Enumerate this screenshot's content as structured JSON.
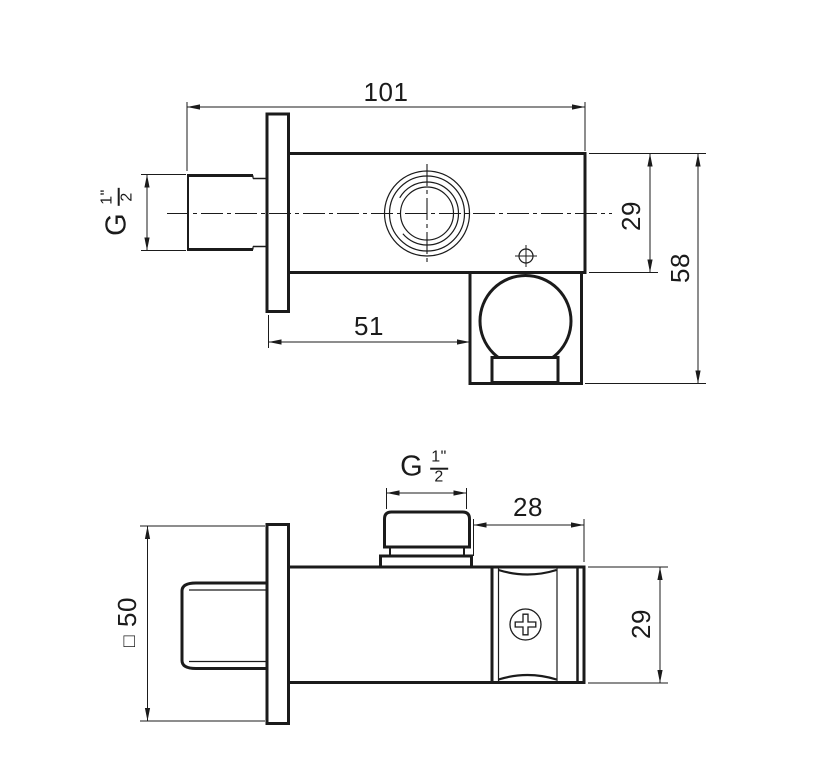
{
  "drawing": {
    "line_color": "#1b1b1b",
    "background": "#ffffff",
    "front_view": {
      "overall_length": "101",
      "body_height": "29",
      "overall_height": "58",
      "wall_to_holder": "51",
      "inlet_thread": {
        "prefix": "G",
        "numerator": "1",
        "inch_mark": "\"",
        "denominator": "2"
      }
    },
    "side_view": {
      "outlet_thread": {
        "prefix": "G",
        "numerator": "1",
        "inch_mark": "\"",
        "denominator": "2"
      },
      "holder_length": "28",
      "holder_height": "29",
      "plate_square_symbol": "□",
      "plate_square_size": "50"
    }
  }
}
